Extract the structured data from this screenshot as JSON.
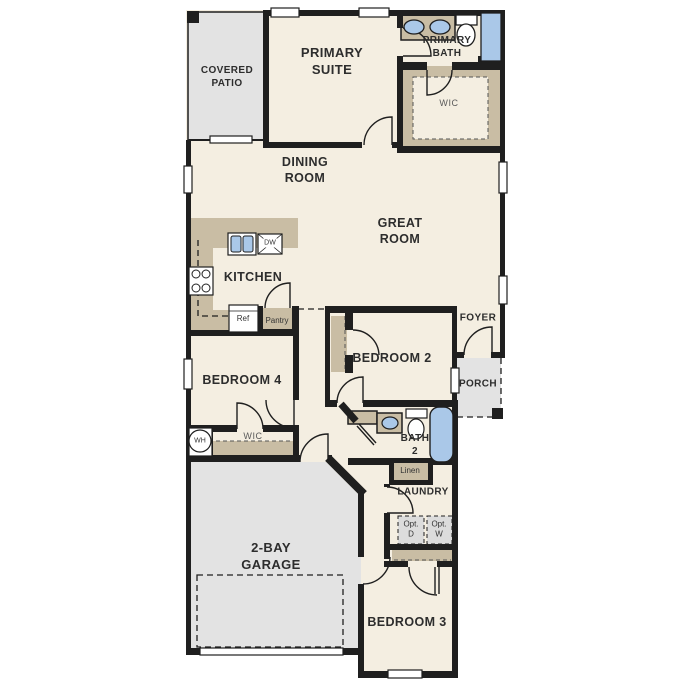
{
  "floorplan": {
    "rooms": {
      "covered_patio": {
        "label": "COVERED\nPATIO"
      },
      "primary_suite": {
        "label": "PRIMARY\nSUITE"
      },
      "primary_bath": {
        "label": "PRIMARY\nBATH"
      },
      "primary_wic": {
        "label": "WIC"
      },
      "dining_room": {
        "label": "DINING\nROOM"
      },
      "great_room": {
        "label": "GREAT\nROOM"
      },
      "kitchen": {
        "label": "KITCHEN"
      },
      "foyer": {
        "label": "FOYER"
      },
      "porch": {
        "label": "PORCH"
      },
      "bedroom_2": {
        "label": "BEDROOM 2"
      },
      "bedroom_4": {
        "label": "BEDROOM 4"
      },
      "bedroom4_wic": {
        "label": "WIC"
      },
      "bath_2": {
        "label": "BATH\n2"
      },
      "laundry": {
        "label": "LAUNDRY"
      },
      "garage": {
        "label": "2-BAY\nGARAGE"
      },
      "bedroom_3": {
        "label": "BEDROOM 3"
      }
    },
    "fixtures": {
      "refrigerator": "Ref",
      "pantry": "Pantry",
      "dishwasher": "DW",
      "water_heater": "WH",
      "linen": "Linen",
      "opt_dryer": "Opt.\nD",
      "opt_washer": "Opt.\nW"
    },
    "palette": {
      "floor": "#f4eee1",
      "outdoor_concrete": "#e3e3e3",
      "casework_tan": "#c9bda4",
      "plumbing_blue": "#aac8e8",
      "wall": "#1f1f1f",
      "label": "#2d2d2d",
      "label_muted": "#5a5a5a"
    }
  }
}
